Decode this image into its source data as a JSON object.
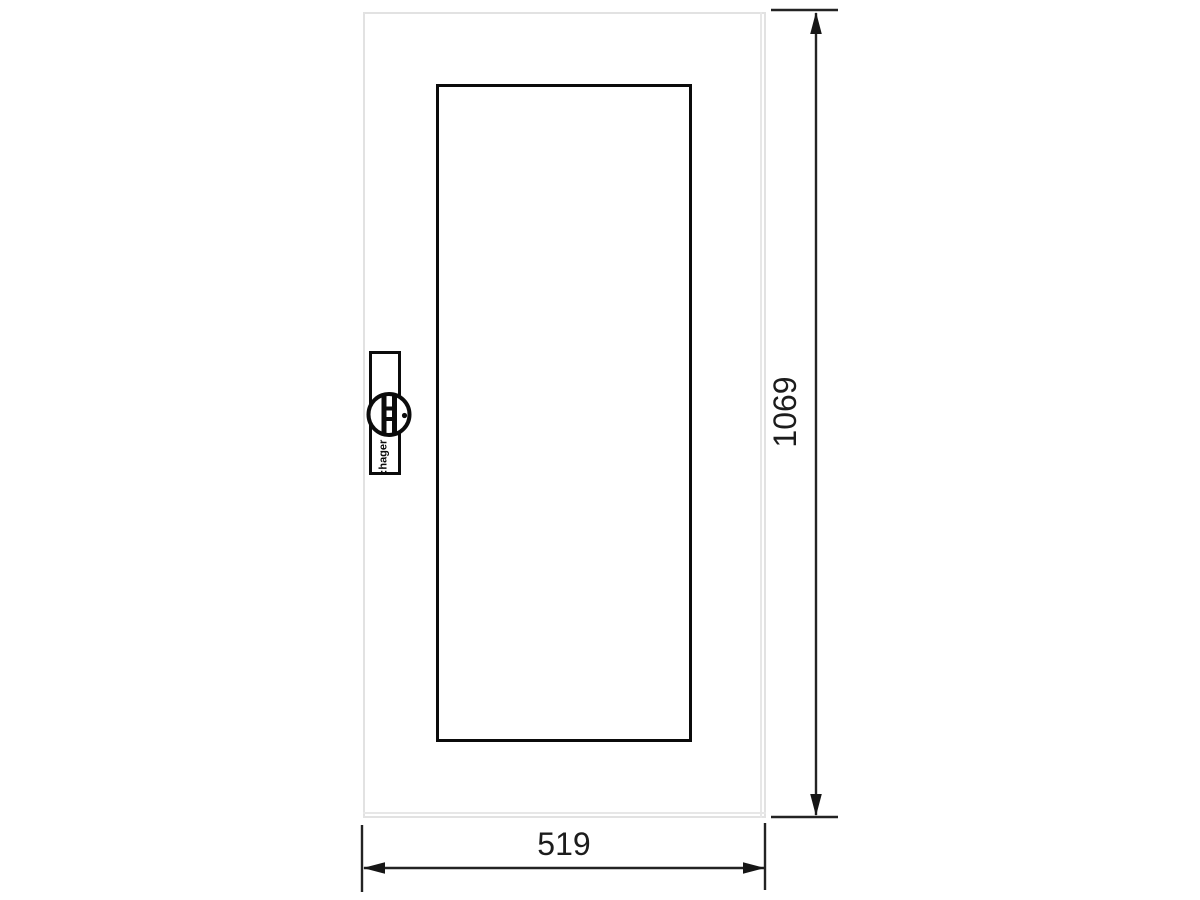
{
  "drawing": {
    "kind": "technical dimension drawing"
  },
  "brand": {
    "label": ":hager"
  },
  "dimensions": {
    "height": {
      "value": "1069"
    },
    "width": {
      "value": "519"
    }
  },
  "colors": {
    "background": "#ffffff",
    "door_outline": "#e2e2e2",
    "drawing_line": "#0b0b0b",
    "dimension_line": "#232323",
    "label_text": "#1c1c1c"
  }
}
